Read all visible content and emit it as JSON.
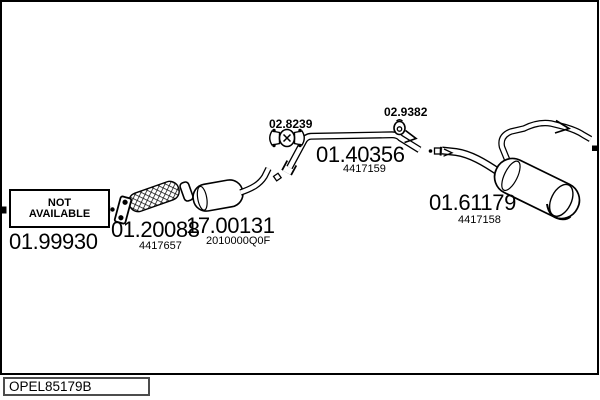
{
  "window": {
    "width": 600,
    "height": 400
  },
  "colors": {
    "line": "#000000",
    "background": "#ffffff"
  },
  "catalog": {
    "code": "OPEL85179B"
  },
  "not_available": {
    "line1": "NOT",
    "line2": "AVAILABLE"
  },
  "parts": {
    "front_pipe": {
      "code": "01.99930"
    },
    "flex_pipe": {
      "code": "01.20088",
      "ref": "4417657"
    },
    "catalyst": {
      "code": "17.00131",
      "ref": "2010000Q0F"
    },
    "clamp": {
      "code": "02.8239"
    },
    "mid_pipe": {
      "code": "01.40356",
      "ref": "4417159"
    },
    "hanger": {
      "code": "02.9382"
    },
    "rear_muffler": {
      "code": "01.61179",
      "ref": "4417158"
    }
  }
}
